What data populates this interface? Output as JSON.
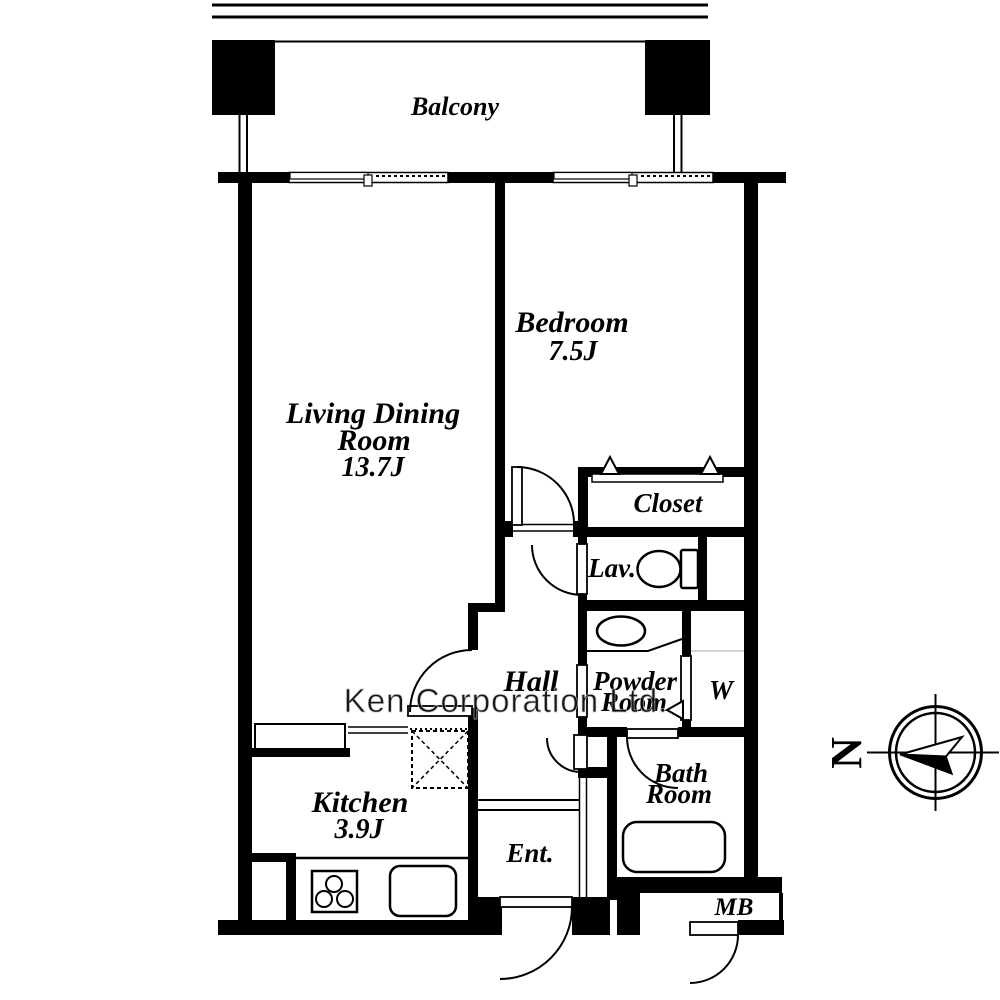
{
  "page": {
    "background": "#ffffff",
    "line_color": "#000000",
    "watermark_color": "#d9d9d9"
  },
  "floorplan": {
    "balcony": {
      "label": "Balcony"
    },
    "living_dining": {
      "label_line1": "Living Dining",
      "label_line2": "Room",
      "size": "13.7J"
    },
    "bedroom": {
      "label": "Bedroom",
      "size": "7.5J"
    },
    "closet": {
      "label": "Closet"
    },
    "lavatory": {
      "label": "Lav."
    },
    "hall": {
      "label": "Hall"
    },
    "powder_room": {
      "label_line1": "Powder",
      "label_line2": "Room"
    },
    "washer": {
      "label": "W"
    },
    "kitchen": {
      "label": "Kitchen",
      "size": "3.9J"
    },
    "bath_room": {
      "label_line1": "Bath",
      "label_line2": "Room"
    },
    "entrance": {
      "label": "Ent."
    },
    "meter_box": {
      "label": "MB"
    },
    "compass": {
      "label": "N"
    },
    "watermark": {
      "label": "Ken Corporation Ltd."
    }
  }
}
